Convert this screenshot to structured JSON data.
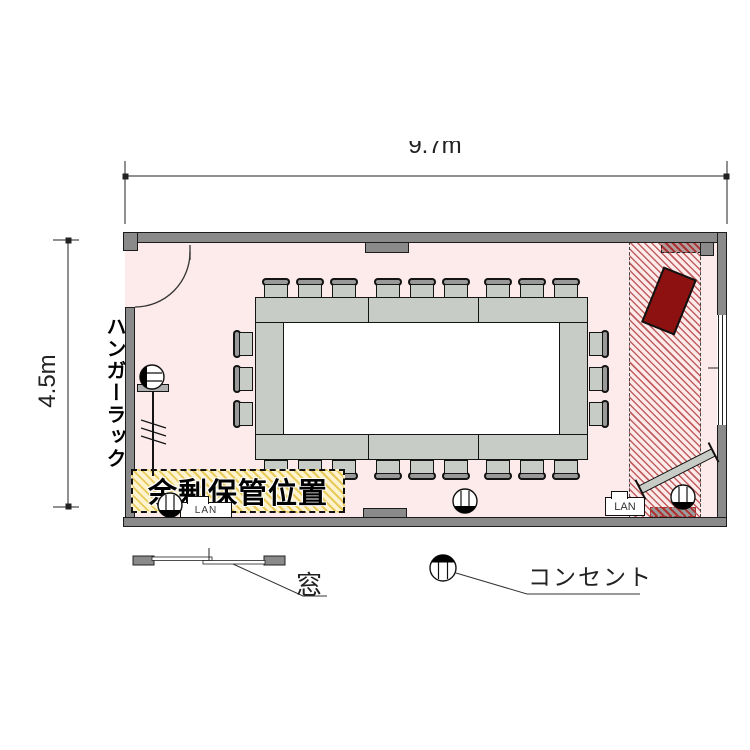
{
  "page": {
    "type": "floor-plan",
    "subject": "meeting room layout"
  },
  "dimensions": {
    "width": "9.7m",
    "height": "4.5m"
  },
  "annotations": {
    "hanger_rack": "ハンガーラック",
    "surplus_storage": "余剰保管位置"
  },
  "ports": {
    "lan_left": "LAN",
    "lan_right": "LAN"
  },
  "legend": {
    "window_label": "窓",
    "outlet_label": "コンセント"
  },
  "colors": {
    "floor": "#fdeaea",
    "wall": "#8a8a8a",
    "table": "#c8ccc6",
    "zone_stripe": "#c25e5e",
    "equipment_red": "#8e1111",
    "storage_hatch_bg": "#fdf3cf",
    "storage_hatch_stripe": "#e8c95a"
  },
  "counts": {
    "chairs": 24,
    "table_segments": 8,
    "outlets": 4,
    "lan_ports": 2
  }
}
